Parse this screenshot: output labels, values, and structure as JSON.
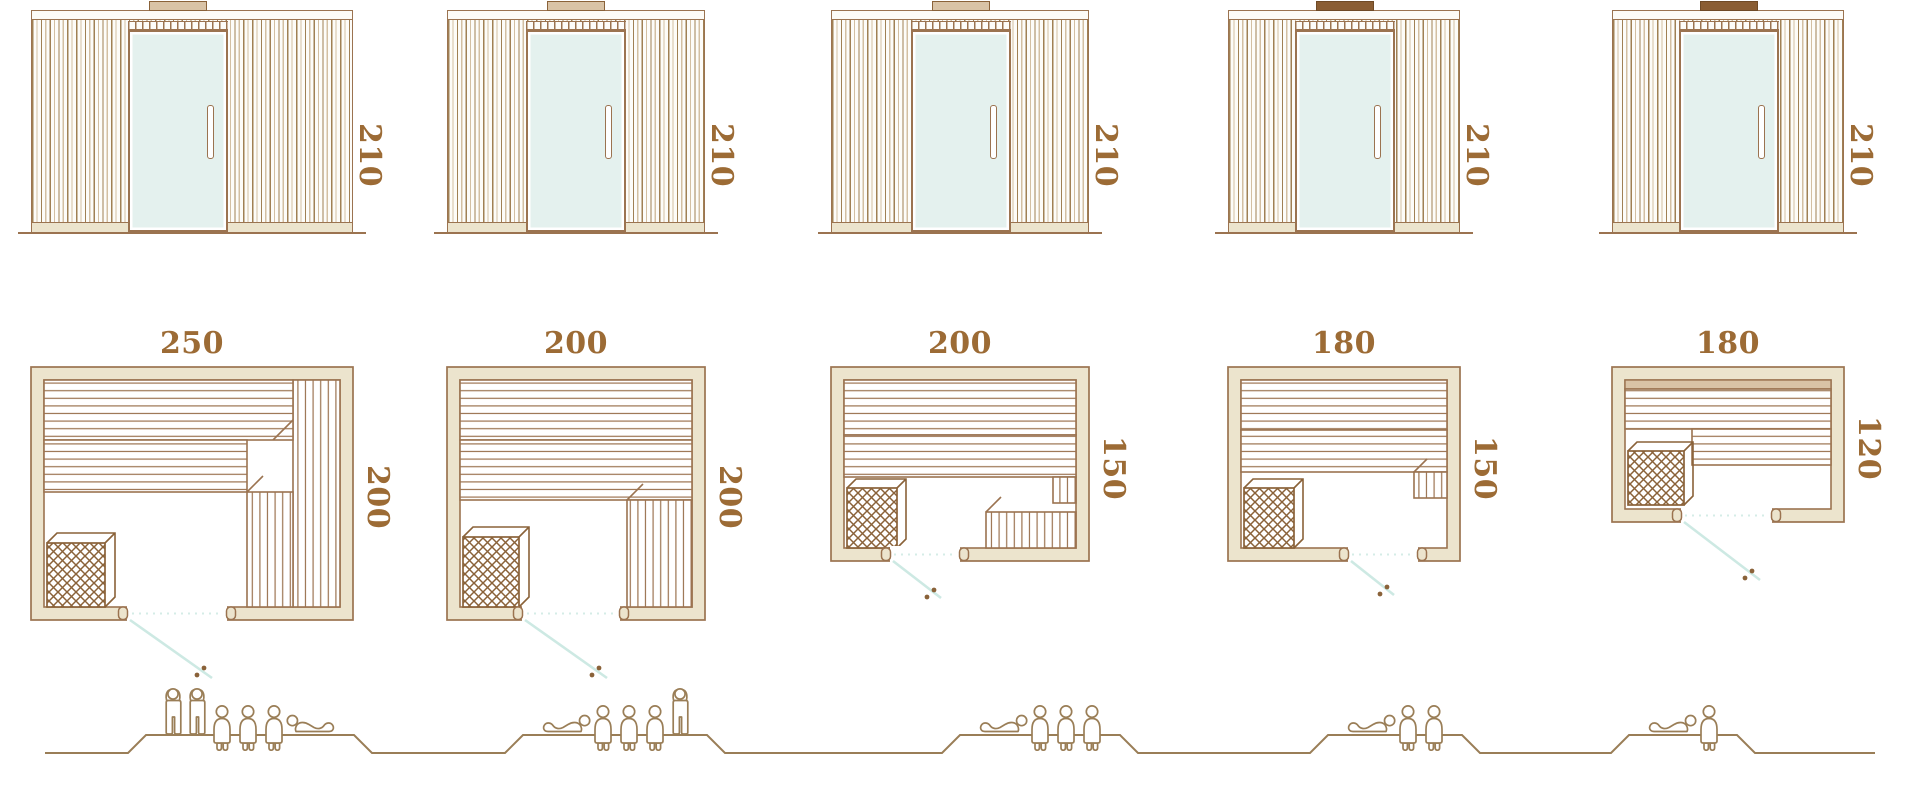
{
  "diagram": {
    "type": "sauna-model-dimension-chart",
    "units_implied": "cm",
    "colors": {
      "line_brown": "#9b7350",
      "dark_brown": "#8a6239",
      "wall_fill": "#ece4cd",
      "bench_tan": "#d9c3a6",
      "glass": "#e4f1ee",
      "label_brown": "#9c6b35",
      "door_swing_teal": "#cde9e3",
      "people_line": "#9a7e57"
    }
  },
  "saunas": [
    {
      "name": "sauna-250x200",
      "elevation": {
        "height_label": "210",
        "roof_cap_style": "light"
      },
      "plan": {
        "width_label": "250",
        "depth_label": "200"
      },
      "capacity": {
        "total": 6,
        "figures": [
          "standing",
          "standing",
          "sitting",
          "sitting",
          "sitting",
          "lying"
        ]
      }
    },
    {
      "name": "sauna-200x200",
      "elevation": {
        "height_label": "210",
        "roof_cap_style": "light"
      },
      "plan": {
        "width_label": "200",
        "depth_label": "200"
      },
      "capacity": {
        "total": 5,
        "figures": [
          "lying",
          "sitting",
          "sitting",
          "sitting",
          "standing"
        ]
      }
    },
    {
      "name": "sauna-200x150",
      "elevation": {
        "height_label": "210",
        "roof_cap_style": "light"
      },
      "plan": {
        "width_label": "200",
        "depth_label": "150"
      },
      "capacity": {
        "total": 4,
        "figures": [
          "lying",
          "sitting",
          "sitting",
          "sitting"
        ]
      }
    },
    {
      "name": "sauna-180x150",
      "elevation": {
        "height_label": "210",
        "roof_cap_style": "dark"
      },
      "plan": {
        "width_label": "180",
        "depth_label": "150"
      },
      "capacity": {
        "total": 3,
        "figures": [
          "lying",
          "sitting",
          "sitting"
        ]
      }
    },
    {
      "name": "sauna-180x120",
      "elevation": {
        "height_label": "210",
        "roof_cap_style": "dark"
      },
      "plan": {
        "width_label": "180",
        "depth_label": "120"
      },
      "capacity": {
        "total": 2,
        "figures": [
          "lying",
          "sitting"
        ]
      }
    }
  ]
}
